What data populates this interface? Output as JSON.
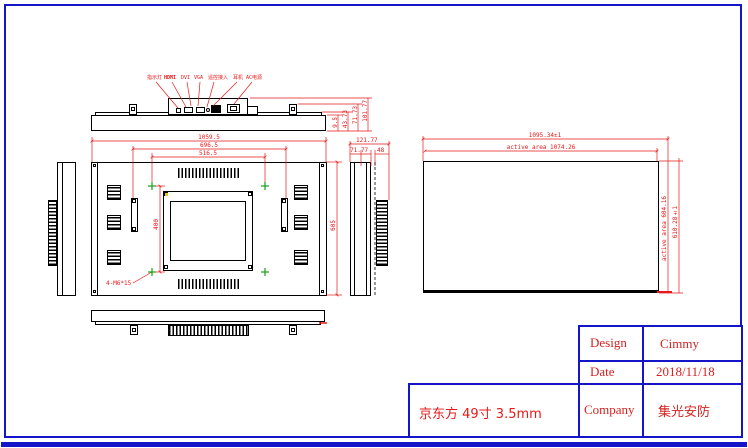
{
  "labels": {
    "indicator": "指示灯",
    "hdmi": "HDMI",
    "dvi": "DVI",
    "vga": "VGA",
    "remote": "遥控接入",
    "earphone": "耳机",
    "ac_power": "AC电源"
  },
  "dims": {
    "front_width_outer": "1059.5",
    "front_width_mid": "696.5",
    "front_width_inner": "516.5",
    "vesa_vertical": "400",
    "front_height": "605",
    "screw_note": "4-M6*15",
    "top_t1": "9.5",
    "top_t2": "43.73",
    "top_t3": "71.73",
    "top_t4": "101.77",
    "side_depth_outer": "121.77",
    "side_depth_mid": "71.77",
    "side_depth_inner": "48",
    "screen_width_outer": "1095.34±1",
    "screen_width_active": "active area 1074.26",
    "screen_height_active": "active area 604.16",
    "screen_height_outer": "610.28±1"
  },
  "title_block": {
    "design_label": "Design",
    "design_value": "Cimmy",
    "date_label": "Date",
    "date_value": "2018/11/18",
    "company_label": "Company",
    "company_value": "集光安防"
  },
  "panel_note": "京东方 49寸 3.5mm",
  "colors": {
    "line": "#000000",
    "dimension": "#e81818",
    "frame": "#1414c8",
    "marker_green": "#18a018",
    "marker_yellow": "#e8c020"
  }
}
